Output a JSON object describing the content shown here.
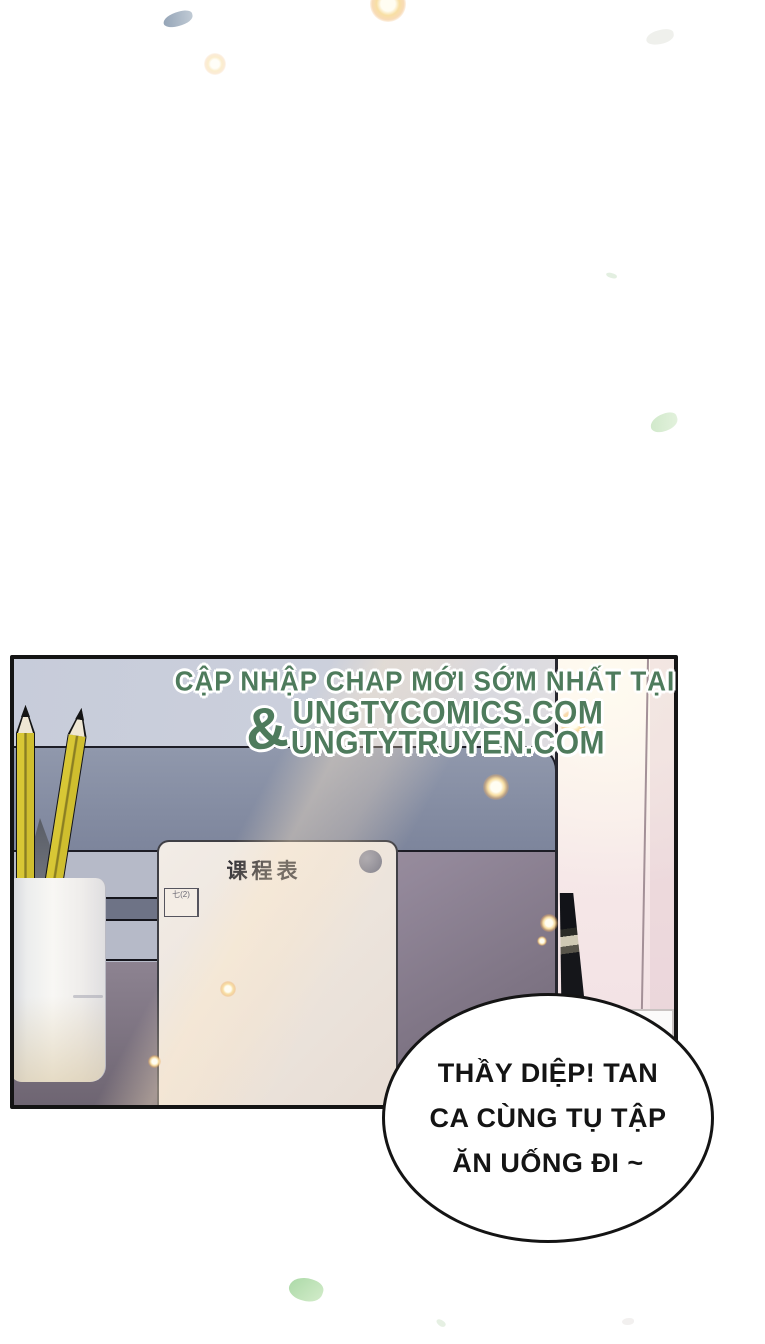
{
  "watermark": {
    "line1": "CẬP NHẬP CHAP MỚI SỚM NHẤT TẠI",
    "ampersand": "&",
    "site1": "UNGTYCOMICS.COM",
    "site2": "UNGTYTRUYEN.COM"
  },
  "schedule": {
    "title": "课程表",
    "columns": [
      "",
      "时间",
      "周一",
      "周二",
      "周三",
      "周四",
      "周五"
    ],
    "rows": [
      {
        "label": "早读",
        "cells": [
          "",
          "",
          "",
          "",
          "",
          ""
        ]
      },
      {
        "label": "第一节",
        "cells": [
          "",
          "",
          "",
          "",
          "",
          ""
        ]
      },
      {
        "label": "第二节",
        "cells": [
          "",
          "",
          "",
          "",
          "",
          ""
        ]
      },
      {
        "label": "第三节",
        "cells": [
          "",
          "",
          "六(3)",
          "",
          "六(4)",
          "六(3)"
        ]
      },
      {
        "label": "第四节",
        "cells": [
          "",
          "",
          "",
          "六(3)",
          "",
          ""
        ]
      },
      {
        "label": "午休",
        "merged": true,
        "cells": [
          ""
        ]
      },
      {
        "label": "第五节",
        "cells": [
          "",
          "七(4)",
          "八(1)",
          "七(1)",
          "八(4)",
          "七(2)"
        ]
      }
    ]
  },
  "speech_bubble": {
    "lines": [
      "THẦY DIỆP! TAN",
      "CA CÙNG TỤ TẬP",
      "ĂN UỐNG ĐI ~"
    ]
  },
  "colors": {
    "watermark_green": "#4e7b5c",
    "outline_black": "#141414",
    "pencil_yellow": "#d7c631",
    "band_slate": "#8089a0",
    "desk_mauve": "#8a8090",
    "wall_pink": "#f6e9e9",
    "card_cream": "#efe8e1",
    "sparkle_orange": "#f3c27d",
    "leaf_green": "#cfe8c9"
  }
}
